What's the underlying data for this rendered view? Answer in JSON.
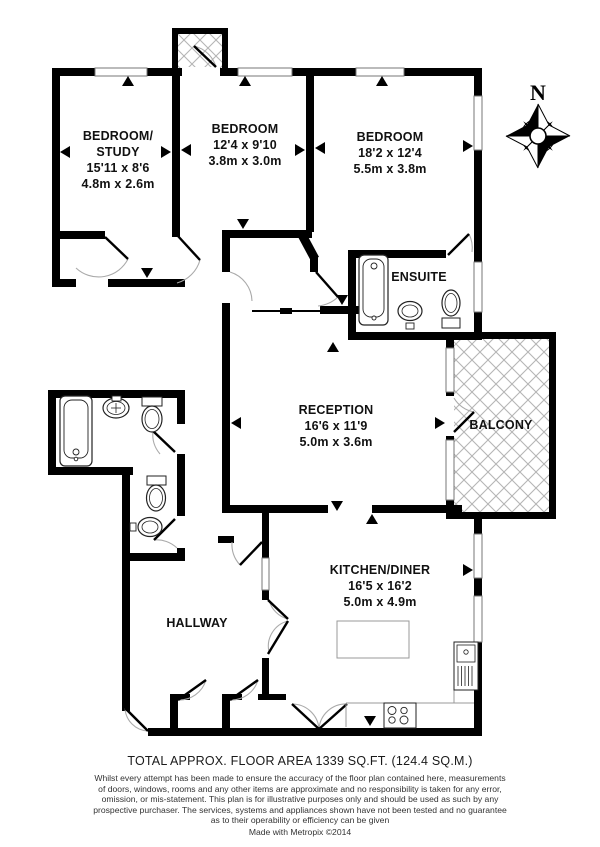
{
  "rooms": {
    "study": {
      "name": "BEDROOM/",
      "name2": "STUDY",
      "imperial": "15'11 x 8'6",
      "metric": "4.8m x 2.6m"
    },
    "bedroom2": {
      "name": "BEDROOM",
      "imperial": "12'4 x 9'10",
      "metric": "3.8m x 3.0m"
    },
    "bedroom3": {
      "name": "BEDROOM",
      "imperial": "18'2 x 12'4",
      "metric": "5.5m x 3.8m"
    },
    "ensuite": {
      "name": "ENSUITE"
    },
    "reception": {
      "name": "RECEPTION",
      "imperial": "16'6 x 11'9",
      "metric": "5.0m x 3.6m"
    },
    "balcony": {
      "name": "BALCONY"
    },
    "kitchen": {
      "name": "KITCHEN/DINER",
      "imperial": "16'5 x 16'2",
      "metric": "5.0m x 4.9m"
    },
    "hallway": {
      "name": "HALLWAY"
    }
  },
  "compass": {
    "north": "N"
  },
  "footer": {
    "area": "TOTAL APPROX. FLOOR AREA 1339 SQ.FT. (124.4 SQ.M.)",
    "disclaimer1": "Whilst every attempt has been made to ensure the accuracy of the floor plan contained here, measurements",
    "disclaimer2": "of doors, windows, rooms and any other items are approximate and no responsibility is taken for any error,",
    "disclaimer3": "omission, or mis-statement. This plan is for illustrative purposes only and should be used as such by any",
    "disclaimer4": "prospective purchaser. The services, systems and appliances shown have not been tested and no guarantee",
    "disclaimer5": "as to their operability or efficiency can be given",
    "credit": "Made with Metropix ©2014"
  },
  "colors": {
    "wall": "#000000",
    "hatch": "#b5b5b5",
    "arc": "#aaaaaa",
    "fixture": "#222222"
  }
}
